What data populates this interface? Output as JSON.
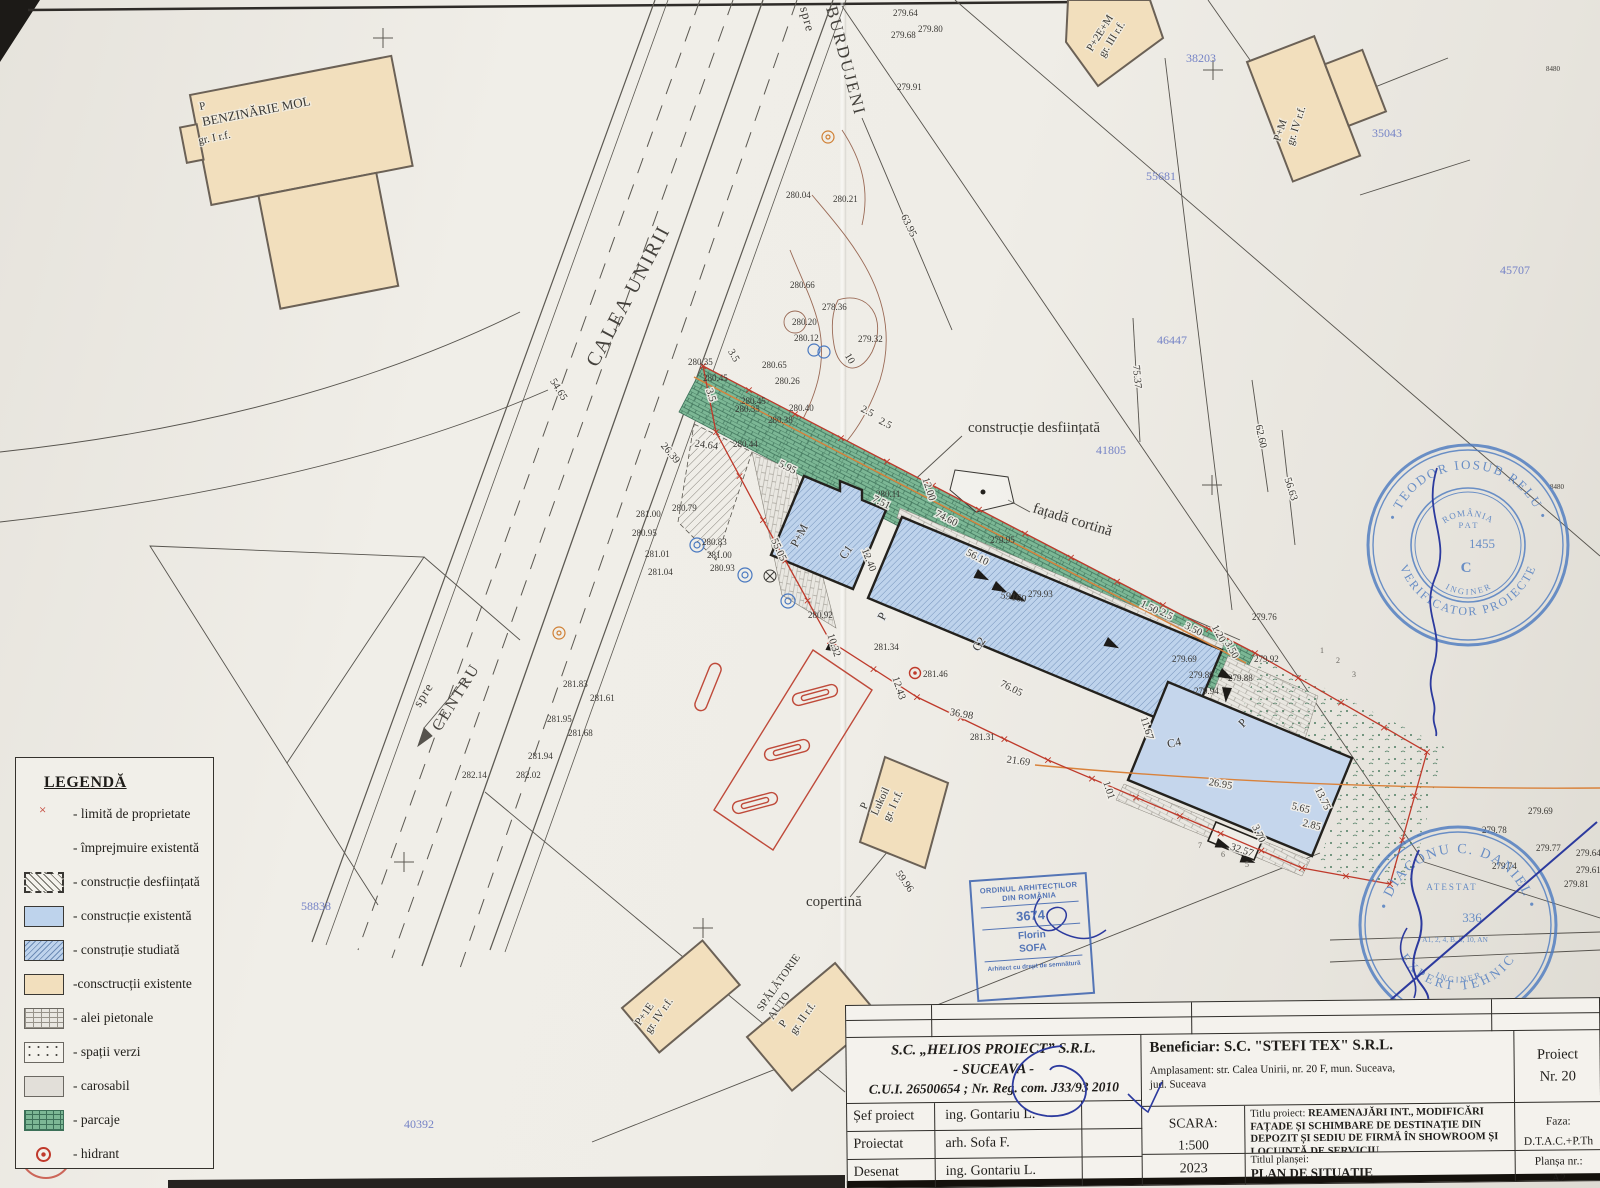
{
  "legend": {
    "title": "LEGENDĂ",
    "items": [
      {
        "label": "- limită de proprietate"
      },
      {
        "label": "- împrejmuire existentă"
      },
      {
        "label": "- construcție desființată"
      },
      {
        "label": "- construcție existentă"
      },
      {
        "label": "- construție studiată"
      },
      {
        "label": "-consctrucții existente"
      },
      {
        "label": "- alei pietonale"
      },
      {
        "label": "- spații verzi"
      },
      {
        "label": "- carosabil"
      },
      {
        "label": "- parcaje"
      },
      {
        "label": "- hidrant"
      }
    ]
  },
  "title_block": {
    "company1": "S.C. „HELIOS PROIECT” S.R.L.",
    "company2": "- SUCEAVA -",
    "company3": "C.U.I. 26500654 ; Nr. Reg. com. J33/93 2010",
    "rows": [
      {
        "role": "Șef proiect",
        "name": "ing. Gontariu L."
      },
      {
        "role": "Proiectat",
        "name": "arh. Sofa F."
      },
      {
        "role": "Desenat",
        "name": "ing. Gontariu L."
      }
    ],
    "beneficiar": "Beneficiar: S.C. \"STEFI TEX\" S.R.L.",
    "ampl1": "Amplasament: str. Calea Unirii, nr. 20 F, mun. Suceava,",
    "ampl2": "jud. Suceava",
    "proiect1": "Proiect",
    "proiect2": "Nr. 20",
    "scara_label": "SCARA:",
    "scara_value": "1:500",
    "titlu_label": "Titlu proiect:",
    "titlu_text": "REAMENAJĂRI INT., MODIFICĂRI FAȚADE ȘI SCHIMBARE DE DESTINAȚIE DIN DEPOZIT ȘI SEDIU DE FIRMĂ ÎN SHOWROOM ȘI LOCUINȚĂ DE SERVICIU",
    "faza_label": "Faza:",
    "faza_value": "D.T.A.C.+P.Th",
    "year": "2023",
    "plansei_label": "Titlul planșei:",
    "plansei_value": "PLAN DE SITUAȚIE",
    "plansa_label": "Planșa nr.:",
    "plansa_value": "A2"
  },
  "stamps": {
    "oar": {
      "l1": "ORDINUL ARHITECȚILOR",
      "l2": "DIN ROMÂNIA",
      "number": "3674",
      "name1": "Florin",
      "name2": "SOFA",
      "footer": "Arhitect cu drept de semnătură"
    },
    "verificator": {
      "ring_top": "• TEODOR IOSUB RELU •",
      "ring_bottom": "VERIFICATOR PROIECTE",
      "romania": "ROMÂNIA",
      "pat": "P A T",
      "number": "1455",
      "letter": "C",
      "inginer": "I N G I N E R"
    },
    "expert": {
      "ring_top": "• DIACONU C. DANIEL •",
      "ring_bottom": "EXPERT TEHNIC",
      "atestat": "ATESTAT",
      "number": "336",
      "categories": "A1, 2, 4, B, 8, 10, AN",
      "inginer": "I N G I N E R"
    }
  },
  "map": {
    "streets": {
      "calea": "CALEA UNIRII",
      "spre_b": "spre",
      "burdujeni": "BURDUJENI",
      "spre_c": "spre",
      "centru": "CENTRU"
    },
    "buildings": {
      "mol_p": "P",
      "mol": "BENZINĂRIE MOL",
      "mol_gr": "gr. I r.f.",
      "p2em": "P+2E+M",
      "p2em_gr": "gr. III r.f.",
      "pm4": "P+M",
      "pm4_gr": "gr. IV r.f.",
      "c1": "C1",
      "c2": "C2",
      "c4": "C4",
      "pm": "P+M",
      "p1": "P",
      "p2": "P",
      "lukoil_p": "P",
      "lukoil": "Lukoil",
      "lukoil_gr": "gr. I r.f.",
      "p1e": "P+1E",
      "p1e_gr": "gr. IV r.f.",
      "spal1": "SPĂLĂTORIE",
      "spal2": "AUTO",
      "spal_p": "P",
      "spal_gr": "gr. II r.f."
    },
    "annotations": {
      "desf": "construcție desființată",
      "fatada": "fațadă cortină",
      "copertina": "copertină"
    },
    "parcel_black": "59169",
    "labels": {
      "elevations": [
        {
          "t": "279.64",
          "x": 893,
          "y": 16
        },
        {
          "t": "279.80",
          "x": 918,
          "y": 32
        },
        {
          "t": "279.68",
          "x": 891,
          "y": 38
        },
        {
          "t": "279.91",
          "x": 897,
          "y": 90
        },
        {
          "t": "280.04",
          "x": 786,
          "y": 198
        },
        {
          "t": "280.21",
          "x": 833,
          "y": 202
        },
        {
          "t": "280.66",
          "x": 790,
          "y": 288
        },
        {
          "t": "278.36",
          "x": 822,
          "y": 310
        },
        {
          "t": "280.20",
          "x": 792,
          "y": 325
        },
        {
          "t": "280.12",
          "x": 794,
          "y": 341
        },
        {
          "t": "279.32",
          "x": 858,
          "y": 342
        },
        {
          "t": "280.35",
          "x": 688,
          "y": 365
        },
        {
          "t": "280.65",
          "x": 762,
          "y": 368
        },
        {
          "t": "280.26",
          "x": 775,
          "y": 384
        },
        {
          "t": "280.45",
          "x": 703,
          "y": 381
        },
        {
          "t": "280.45",
          "x": 741,
          "y": 404
        },
        {
          "t": "280.35",
          "x": 735,
          "y": 412
        },
        {
          "t": "280.40",
          "x": 789,
          "y": 411
        },
        {
          "t": "280.38",
          "x": 768,
          "y": 423
        },
        {
          "t": "280.44",
          "x": 733,
          "y": 447
        },
        {
          "t": "281.00",
          "x": 636,
          "y": 517
        },
        {
          "t": "280.79",
          "x": 672,
          "y": 511
        },
        {
          "t": "280.95",
          "x": 632,
          "y": 536
        },
        {
          "t": "280.83",
          "x": 702,
          "y": 545
        },
        {
          "t": "281.01",
          "x": 645,
          "y": 557
        },
        {
          "t": "281.00",
          "x": 707,
          "y": 558
        },
        {
          "t": "280.93",
          "x": 710,
          "y": 571
        },
        {
          "t": "281.04",
          "x": 648,
          "y": 575
        },
        {
          "t": "280.11",
          "x": 876,
          "y": 497
        },
        {
          "t": "279.95",
          "x": 990,
          "y": 543
        },
        {
          "t": "280.92",
          "x": 808,
          "y": 618
        },
        {
          "t": "281.34",
          "x": 874,
          "y": 650
        },
        {
          "t": "281.46",
          "x": 923,
          "y": 677
        },
        {
          "t": "281.31",
          "x": 970,
          "y": 740
        },
        {
          "t": "279.93",
          "x": 1028,
          "y": 597
        },
        {
          "t": "279.76",
          "x": 1252,
          "y": 620
        },
        {
          "t": "279.92",
          "x": 1254,
          "y": 662
        },
        {
          "t": "279.69",
          "x": 1172,
          "y": 662
        },
        {
          "t": "279.89",
          "x": 1189,
          "y": 678
        },
        {
          "t": "279.88",
          "x": 1228,
          "y": 681
        },
        {
          "t": "279.94",
          "x": 1194,
          "y": 694
        },
        {
          "t": "281.83",
          "x": 563,
          "y": 687
        },
        {
          "t": "281.61",
          "x": 590,
          "y": 701
        },
        {
          "t": "281.95",
          "x": 547,
          "y": 722
        },
        {
          "t": "281.68",
          "x": 568,
          "y": 736
        },
        {
          "t": "281.94",
          "x": 528,
          "y": 759
        },
        {
          "t": "282.02",
          "x": 516,
          "y": 778
        },
        {
          "t": "282.14",
          "x": 462,
          "y": 778
        },
        {
          "t": "279.69",
          "x": 1528,
          "y": 814
        },
        {
          "t": "279.78",
          "x": 1482,
          "y": 833
        },
        {
          "t": "279.77",
          "x": 1536,
          "y": 851
        },
        {
          "t": "279.64",
          "x": 1576,
          "y": 856
        },
        {
          "t": "279.74",
          "x": 1492,
          "y": 869
        },
        {
          "t": "279.61",
          "x": 1576,
          "y": 873
        },
        {
          "t": "279.81",
          "x": 1564,
          "y": 887
        }
      ],
      "dimensions": [
        {
          "t": "63.95",
          "x": 906,
          "y": 227,
          "r": 64
        },
        {
          "t": "75.37",
          "x": 1134,
          "y": 377,
          "r": 85
        },
        {
          "t": "62.60",
          "x": 1258,
          "y": 437,
          "r": 78
        },
        {
          "t": "56.63",
          "x": 1288,
          "y": 490,
          "r": 72
        },
        {
          "t": "54.65",
          "x": 556,
          "y": 391,
          "r": 58
        },
        {
          "t": "26.39",
          "x": 668,
          "y": 455,
          "r": 50
        },
        {
          "t": "74.60",
          "x": 945,
          "y": 521,
          "r": 27
        },
        {
          "t": "56.10",
          "x": 976,
          "y": 560,
          "r": 27
        },
        {
          "t": "12.00",
          "x": 926,
          "y": 490,
          "r": 72
        },
        {
          "t": "12.40",
          "x": 866,
          "y": 561,
          "r": 68
        },
        {
          "t": "10.32",
          "x": 831,
          "y": 646,
          "r": 72
        },
        {
          "t": "12.43",
          "x": 896,
          "y": 689,
          "r": 72
        },
        {
          "t": "36.98",
          "x": 961,
          "y": 717,
          "r": 10
        },
        {
          "t": "21.69",
          "x": 1018,
          "y": 764,
          "r": 8
        },
        {
          "t": "59.96",
          "x": 902,
          "y": 883,
          "r": 55
        },
        {
          "t": "32.57",
          "x": 1241,
          "y": 853,
          "r": 18
        },
        {
          "t": "11.67",
          "x": 1144,
          "y": 729,
          "r": 73
        },
        {
          "t": "26.95",
          "x": 1220,
          "y": 787,
          "r": 10
        },
        {
          "t": "13.75",
          "x": 1320,
          "y": 800,
          "r": 64
        },
        {
          "t": "76.05",
          "x": 1010,
          "y": 691,
          "r": 27
        },
        {
          "t": "2.5",
          "x": 866,
          "y": 414,
          "r": 27
        },
        {
          "t": "2.5",
          "x": 884,
          "y": 426,
          "r": 27
        },
        {
          "t": "2.5",
          "x": 1165,
          "y": 617,
          "r": 27
        },
        {
          "t": "3.50",
          "x": 1192,
          "y": 632,
          "r": 27
        },
        {
          "t": "1.20",
          "x": 1216,
          "y": 635,
          "r": 62
        },
        {
          "t": "3.50",
          "x": 1229,
          "y": 651,
          "r": 62
        },
        {
          "t": "1.50",
          "x": 1148,
          "y": 610,
          "r": 27
        },
        {
          "t": "7.51",
          "x": 880,
          "y": 505,
          "r": 27
        },
        {
          "t": "3.5",
          "x": 731,
          "y": 357,
          "r": 60
        },
        {
          "t": "3.5",
          "x": 708,
          "y": 396,
          "r": 72
        },
        {
          "t": "24.64",
          "x": 706,
          "y": 448,
          "r": 8
        },
        {
          "t": "5.95",
          "x": 786,
          "y": 470,
          "r": 27
        },
        {
          "t": "55.05",
          "x": 776,
          "y": 551,
          "r": 65
        },
        {
          "t": "1.01",
          "x": 1106,
          "y": 791,
          "r": 72
        },
        {
          "t": "3.70",
          "x": 1256,
          "y": 835,
          "r": 64
        },
        {
          "t": "5.65",
          "x": 1300,
          "y": 811,
          "r": 14
        },
        {
          "t": "2.85",
          "x": 1311,
          "y": 828,
          "r": 14
        },
        {
          "t": "10",
          "x": 847,
          "y": 360,
          "r": 60
        }
      ],
      "parcels": [
        {
          "t": "38203",
          "x": 1186,
          "y": 62
        },
        {
          "t": "35043",
          "x": 1372,
          "y": 137
        },
        {
          "t": "55681",
          "x": 1146,
          "y": 180
        },
        {
          "t": "46447",
          "x": 1157,
          "y": 344
        },
        {
          "t": "45707",
          "x": 1500,
          "y": 274
        },
        {
          "t": "41805",
          "x": 1096,
          "y": 454
        },
        {
          "t": "58838",
          "x": 301,
          "y": 910
        },
        {
          "t": "40392",
          "x": 404,
          "y": 1128
        }
      ],
      "lot_numbers": [
        {
          "t": "1",
          "x": 1320,
          "y": 653
        },
        {
          "t": "2",
          "x": 1336,
          "y": 663
        },
        {
          "t": "3",
          "x": 1352,
          "y": 677
        },
        {
          "t": "5",
          "x": 1245,
          "y": 867
        },
        {
          "t": "6",
          "x": 1221,
          "y": 857
        },
        {
          "t": "7",
          "x": 1198,
          "y": 848
        }
      ],
      "edge_marks": [
        {
          "t": "8480",
          "x": 1546,
          "y": 71
        },
        {
          "t": "8480",
          "x": 1550,
          "y": 489
        }
      ]
    }
  }
}
